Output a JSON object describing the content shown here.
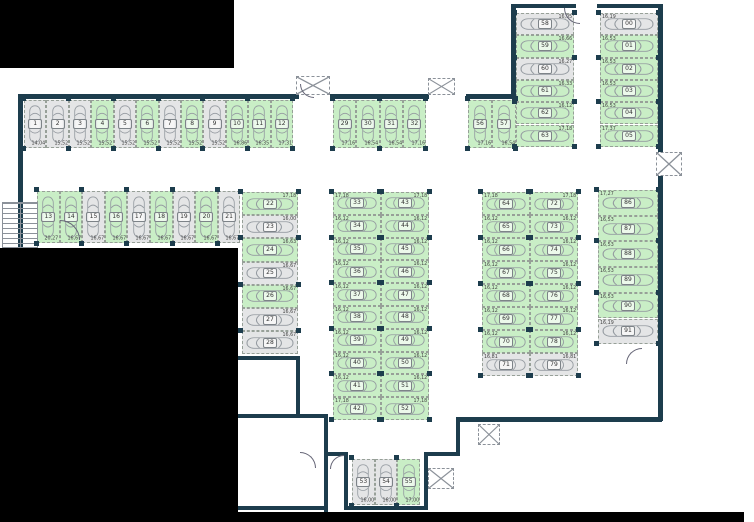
{
  "plan": {
    "type": "parking-garage-floor-plan",
    "stall_fields": [
      "number",
      "area_m2",
      "state"
    ],
    "states": {
      "f": "free",
      "o": "occupied"
    },
    "colors": {
      "free_fill": "#c9eec6",
      "occupied_fill": "#e4e5e6",
      "wall": "#1d3d4d"
    },
    "icons": {
      "car": "car-top-view-icon",
      "shaft": "crossed-box-shaft-icon",
      "stairs": "stairs-icon",
      "door": "door-swing-icon"
    },
    "groups": [
      {
        "id": "row_nw",
        "stalls": [
          [
            "1",
            "14,04",
            "o"
          ],
          [
            "2",
            "15,52",
            "o"
          ],
          [
            "3",
            "15,52",
            "o"
          ],
          [
            "4",
            "15,52",
            "f"
          ],
          [
            "5",
            "15,52",
            "o"
          ],
          [
            "6",
            "15,52",
            "f"
          ],
          [
            "7",
            "15,52",
            "o"
          ],
          [
            "8",
            "15,52",
            "f"
          ],
          [
            "9",
            "15,52",
            "o"
          ],
          [
            "10",
            "16,86",
            "f"
          ],
          [
            "11",
            "16,35",
            "f"
          ],
          [
            "12",
            "17,31",
            "f"
          ]
        ]
      },
      {
        "id": "row_n_center",
        "stalls": [
          [
            "29",
            "17,16",
            "f"
          ],
          [
            "30",
            "16,54",
            "f"
          ],
          [
            "31",
            "16,54",
            "f"
          ],
          [
            "32",
            "17,16",
            "f"
          ]
        ]
      },
      {
        "id": "row_n_east",
        "stalls": [
          [
            "56",
            "17,16",
            "f"
          ],
          [
            "57",
            "16,54",
            "f"
          ]
        ]
      },
      {
        "id": "row_w2",
        "stalls": [
          [
            "13",
            "20,27",
            "f"
          ],
          [
            "14",
            "16,67",
            "f"
          ],
          [
            "15",
            "16,67",
            "o"
          ],
          [
            "16",
            "16,67",
            "f"
          ],
          [
            "17",
            "16,67",
            "o"
          ],
          [
            "18",
            "16,67",
            "f"
          ],
          [
            "19",
            "16,67",
            "o"
          ],
          [
            "20",
            "16,67",
            "f"
          ],
          [
            "21",
            "16,67",
            "o"
          ]
        ]
      },
      {
        "id": "stack_w",
        "stalls": [
          [
            "22",
            "17,18",
            "f"
          ],
          [
            "23",
            "16,00",
            "o"
          ],
          [
            "24",
            "16,63",
            "f"
          ],
          [
            "25",
            "16,67",
            "o"
          ],
          [
            "26",
            "16,67",
            "f"
          ],
          [
            "27",
            "16,67",
            "o"
          ],
          [
            "28",
            "16,67",
            "o"
          ]
        ]
      },
      {
        "id": "col_c_left",
        "stalls": [
          [
            "33",
            "17,18",
            "f"
          ],
          [
            "34",
            "16,12",
            "f"
          ],
          [
            "35",
            "16,12",
            "f"
          ],
          [
            "36",
            "16,12",
            "f"
          ],
          [
            "37",
            "16,12",
            "f"
          ],
          [
            "38",
            "16,12",
            "f"
          ],
          [
            "39",
            "16,12",
            "f"
          ],
          [
            "40",
            "16,12",
            "f"
          ],
          [
            "41",
            "16,12",
            "f"
          ],
          [
            "42",
            "17,18",
            "f"
          ]
        ]
      },
      {
        "id": "col_c_right",
        "stalls": [
          [
            "43",
            "17,18",
            "f"
          ],
          [
            "44",
            "16,12",
            "f"
          ],
          [
            "45",
            "16,12",
            "f"
          ],
          [
            "46",
            "16,12",
            "f"
          ],
          [
            "47",
            "16,12",
            "f"
          ],
          [
            "48",
            "16,12",
            "f"
          ],
          [
            "49",
            "16,12",
            "f"
          ],
          [
            "50",
            "16,12",
            "f"
          ],
          [
            "51",
            "16,12",
            "f"
          ],
          [
            "52",
            "17,18",
            "f"
          ]
        ]
      },
      {
        "id": "col_e_left",
        "stalls": [
          [
            "64",
            "17,18",
            "f"
          ],
          [
            "65",
            "16,12",
            "f"
          ],
          [
            "66",
            "16,12",
            "f"
          ],
          [
            "67",
            "16,12",
            "f"
          ],
          [
            "68",
            "16,12",
            "f"
          ],
          [
            "69",
            "16,12",
            "f"
          ],
          [
            "70",
            "16,12",
            "f"
          ],
          [
            "71",
            "16,81",
            "o"
          ]
        ]
      },
      {
        "id": "col_e_right",
        "stalls": [
          [
            "72",
            "17,18",
            "f"
          ],
          [
            "73",
            "16,12",
            "f"
          ],
          [
            "74",
            "16,12",
            "f"
          ],
          [
            "75",
            "16,12",
            "f"
          ],
          [
            "76",
            "16,12",
            "f"
          ],
          [
            "77",
            "16,12",
            "f"
          ],
          [
            "78",
            "16,12",
            "f"
          ],
          [
            "79",
            "16,81",
            "o"
          ]
        ]
      },
      {
        "id": "col_ne_left",
        "stalls": [
          [
            "58",
            "16,05",
            "o"
          ],
          [
            "59",
            "16,66",
            "f"
          ],
          [
            "60",
            "16,27",
            "o"
          ],
          [
            "61",
            "16,33",
            "f"
          ],
          [
            "62",
            "16,12",
            "f"
          ],
          [
            "63",
            "17,18",
            "f"
          ]
        ]
      },
      {
        "id": "col_ne_right",
        "stalls": [
          [
            "00",
            "16,19",
            "o"
          ],
          [
            "01",
            "16,53",
            "f"
          ],
          [
            "02",
            "16,53",
            "f"
          ],
          [
            "03",
            "16,53",
            "f"
          ],
          [
            "04",
            "16,53",
            "f"
          ],
          [
            "05",
            "17,37",
            "f"
          ]
        ]
      },
      {
        "id": "col_far_east",
        "stalls": [
          [
            "86",
            "17,27",
            "f"
          ],
          [
            "87",
            "16,53",
            "f"
          ],
          [
            "88",
            "16,53",
            "f"
          ],
          [
            "89",
            "16,53",
            "f"
          ],
          [
            "90",
            "16,53",
            "f"
          ],
          [
            "91",
            "16,19",
            "o"
          ]
        ]
      },
      {
        "id": "row_s",
        "stalls": [
          [
            "53",
            "16,00",
            "o"
          ],
          [
            "54",
            "16,00",
            "o"
          ],
          [
            "55",
            "17,00",
            "f"
          ]
        ]
      }
    ]
  }
}
